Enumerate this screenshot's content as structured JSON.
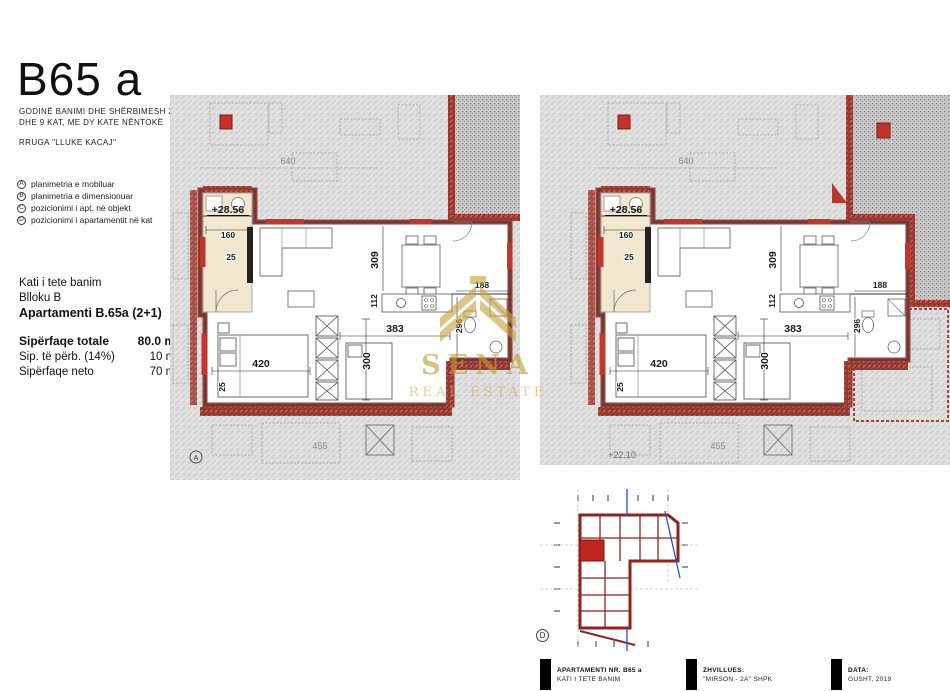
{
  "header": {
    "title": "B65 a",
    "subtitle_line1": "GODINË BANIMI DHE SHËRBIMESH 2, 7",
    "subtitle_line2": "DHE 9 KAT, ME DY KATE NËNTOKË",
    "address": "RRUGA \"LLUKE KACAJ\""
  },
  "legend": {
    "items": [
      {
        "key": "A",
        "label": "planimetria e mobiluar"
      },
      {
        "key": "B",
        "label": "planimetria e dimensionuar"
      },
      {
        "key": "C",
        "label": "pozicionimi i apt. në objekt"
      },
      {
        "key": "D",
        "label": "pozicionimi i apartamentit në kat"
      }
    ]
  },
  "info": {
    "floor": "Kati i tete banim",
    "block": "Blloku B",
    "apartment": "Apartamenti B.65a (2+1)",
    "areas": [
      {
        "label": "Sipërfaqe totale",
        "value": "80.0 m²"
      },
      {
        "label": "Sip. të përb. (14%)",
        "value": "10 m²"
      },
      {
        "label": "Sipërfaqe neto",
        "value": "70 m²"
      }
    ]
  },
  "plan_labels": {
    "level": "+28.56",
    "hall_width": "160",
    "hall_note": "25",
    "bedroom_width": "420",
    "room2_width": "383",
    "room2_depth": "300",
    "dining_depth": "309",
    "wall": "112",
    "bath_width": "188",
    "bath_depth": "296",
    "bed_side": "25",
    "neighbor_top": "640",
    "neighbor_bottom": "455",
    "neighbor_level": "+22.10",
    "marker_a": "A",
    "marker_d": "D"
  },
  "watermark": {
    "name": "SENA",
    "tagline": "REAL ESTATE",
    "color": "#c49a35"
  },
  "titleblock": {
    "blocks": [
      {
        "title": "APARTAMENTI NR. B65 a",
        "subtitle": "KATI I TETE BANIM"
      },
      {
        "title": "ZHVILLUES:",
        "subtitle": "\"MIRSON - 2A\" SHPK"
      },
      {
        "title": "DATA:",
        "subtitle": "GUSHT, 2019"
      }
    ]
  }
}
